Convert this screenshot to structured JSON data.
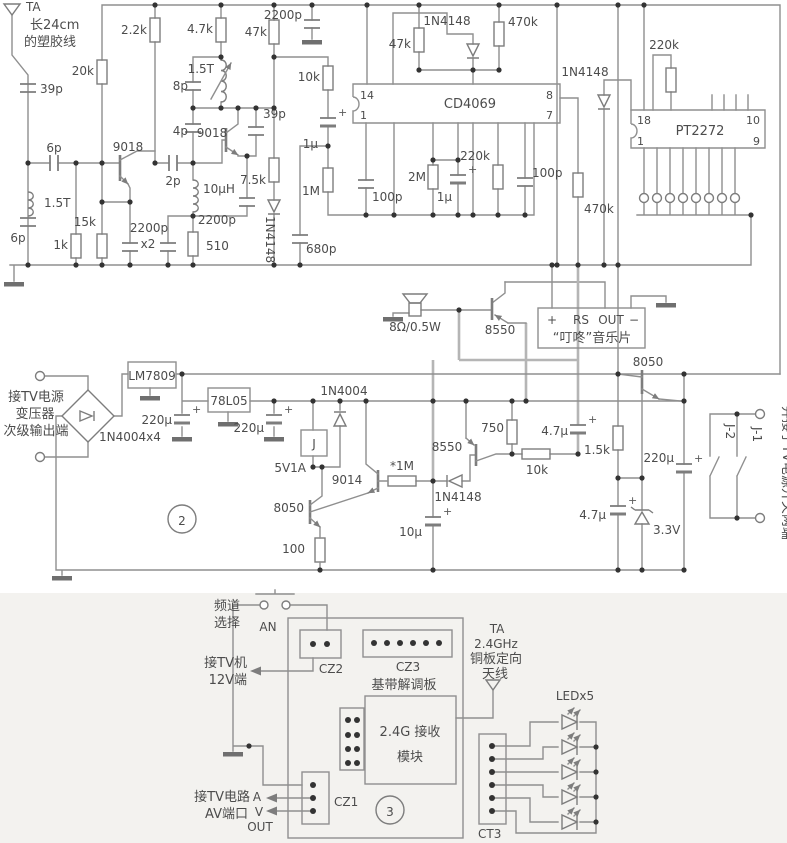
{
  "meta": {
    "bg": "#ffffff",
    "bottom_bg": "#f3f2ef",
    "wire_color": "#8f8f8f",
    "text_color": "#4c4c4c"
  },
  "sym": {
    "plus": "+"
  },
  "s1": {
    "ta": "TA",
    "ant1": "长24cm",
    "ant2": "的塑胶线",
    "c39p_a": "39p",
    "r20k": "20k",
    "r2k2": "2.2k",
    "r4k7": "4.7k",
    "r47k_a": "47k",
    "c2200p_top": "2200p",
    "l15t_b": "1.5T",
    "c8p": "8p",
    "c39p_b": "39p",
    "c4p": "4p",
    "q9018_b": "9018",
    "q9018_a": "9018",
    "c6p_a": "6p",
    "c2p": "2p",
    "l10uh": "10µH",
    "r7k5": "7.5k",
    "l15t_a": "1.5T",
    "c6p_b": "6p",
    "r1k": "1k",
    "r15k": "15k",
    "c2200p_x2a": "2200p",
    "c2200p_x2b": "x2",
    "r510": "510",
    "c2200p_c": "2200p",
    "d1": "1N4148",
    "r10k": "10k",
    "r47k_b": "47k",
    "d2": "1N4148",
    "r470k_a": "470k",
    "ic1": "CD4069",
    "p14": "14",
    "p1": "1",
    "p8": "8",
    "p7": "7",
    "c1u_a": "1µ",
    "r1m": "1M",
    "c100p_a": "100p",
    "r2m": "2M",
    "c1u_b": "1µ",
    "r220k_a": "220k",
    "c100p_b": "100p",
    "c680p": "680p",
    "d3": "1N4148",
    "r220k_b": "220k",
    "ic2": "PT2272",
    "p18": "18",
    "p1b": "1",
    "p10": "10",
    "p9": "9",
    "r470k_b": "470k"
  },
  "mid": {
    "spk": "8Ω/0.5W",
    "q8550": "8550",
    "plus": "+",
    "rs": "RS",
    "out": "OUT",
    "minus": "−",
    "music": "“叮咚”音乐片",
    "q8050": "8050"
  },
  "s2": {
    "src1": "接TV电源",
    "src2": "变压器",
    "src3": "次级输出端",
    "bridge": "1N4004x4",
    "reg1": "LM7809",
    "c220u_a": "220µ",
    "reg2": "78L05",
    "c220u_b": "220µ",
    "d4": "1N4004",
    "relay": "J",
    "v5": "5V1A",
    "q9014": "9014",
    "q8050b": "8050",
    "r1m_s": "*1M",
    "r100": "100",
    "c10u": "10µ",
    "d5": "1N4148",
    "q8550b": "8550",
    "r750": "750",
    "r10k_b": "10k",
    "c4u7_a": "4.7µ",
    "r1k5": "1.5k",
    "c220u_c": "220µ",
    "c4u7_b": "4.7µ",
    "z33": "3.3V",
    "num": "2",
    "j1": "J-1",
    "j2": "J-2",
    "right_note": "并接于TV电源开关两端"
  },
  "s3": {
    "ch1": "频道",
    "ch2": "选择",
    "an": "AN",
    "tv1": "接TV机",
    "tv2": "12V端",
    "cz2": "CZ2",
    "cz3": "CZ3",
    "board": "基带解调板",
    "mod1": "2.4G 接收",
    "mod2": "模块",
    "ta": "TA",
    "ghz": "2.4GHz",
    "ant3": "铜板定向",
    "ant4": "天线",
    "led": "LEDx5",
    "ct3": "CT3",
    "av1": "接TV电路",
    "av2": "AV端口",
    "a": "A",
    "v": "V",
    "outp": "OUT",
    "cz1": "CZ1",
    "num": "3"
  }
}
